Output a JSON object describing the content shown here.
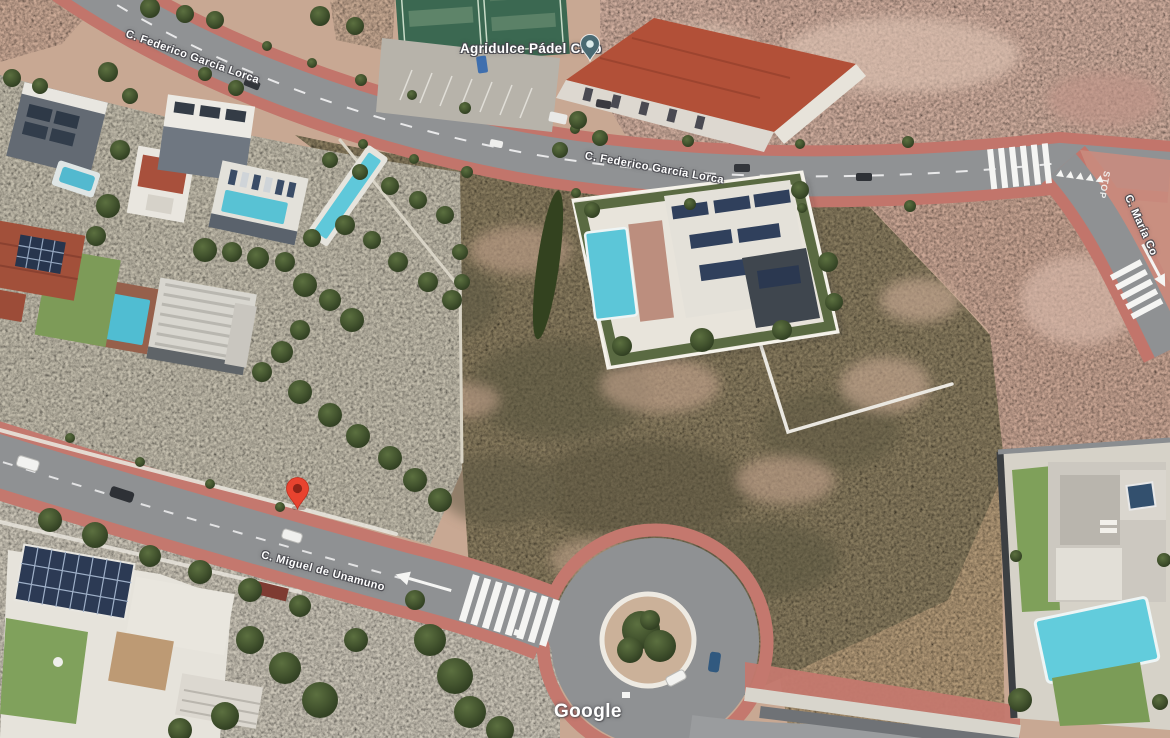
{
  "map": {
    "watermark": "Google",
    "poi": {
      "label": "Agridulce Pádel Club"
    },
    "roads": {
      "federico_upper": "C. Federico García Lorca",
      "federico_center": "C. Federico García Lorca",
      "miguel": "C. Miguel de Unamuno",
      "maria": "C. María Co",
      "stop": "STOP"
    },
    "marker": {
      "type": "destination-pin",
      "color": "#e8432f",
      "inner_color": "#8e2418"
    },
    "poi_pin": {
      "type": "place-pin",
      "color": "#4a6a72",
      "inner_color": "#dcebea"
    },
    "palette": {
      "road_gray": "#8f9193",
      "sidewalk_red": "#c4786e",
      "dirt_tan": "#c8a893",
      "dirt_pink": "#d1af9f",
      "scrub_olive": "#8a7d60",
      "pool_teal": "#5cc6d8",
      "court_green": "#3b6851",
      "tree_green": "#44552f",
      "roof_red": "#b25038"
    }
  }
}
